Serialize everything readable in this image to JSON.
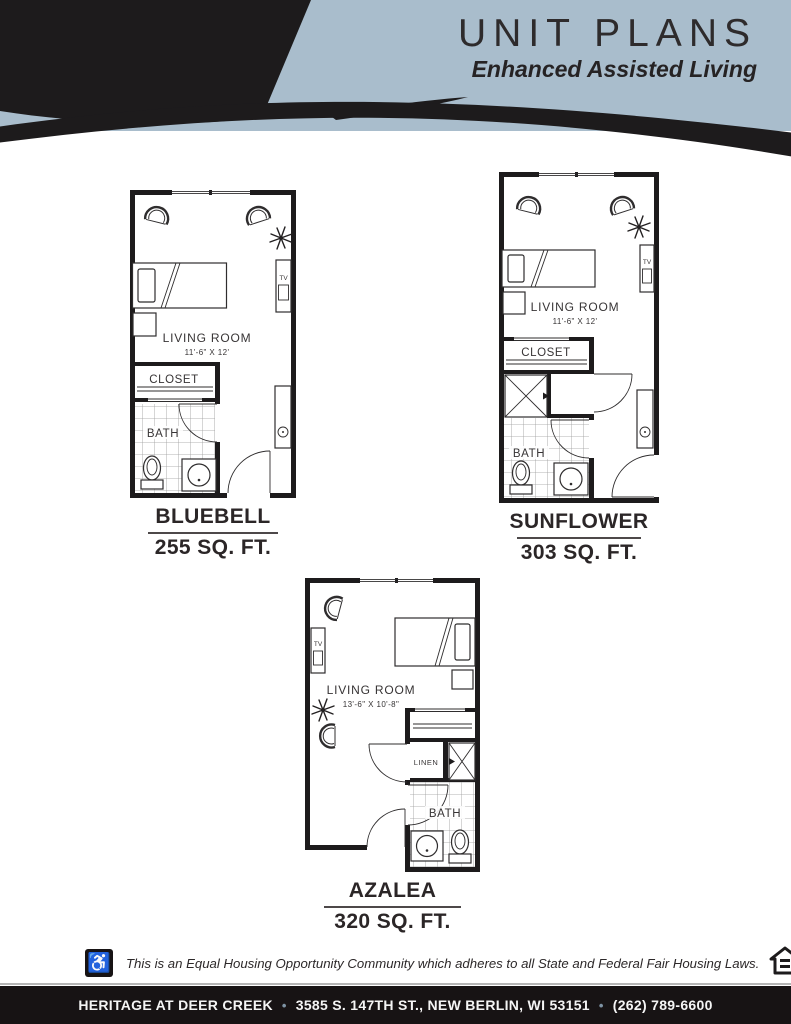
{
  "header": {
    "title": "UNIT PLANS",
    "subtitle": "Enhanced Assisted Living",
    "bg_color": "#a9bdcc",
    "ink_color": "#1d1b1c"
  },
  "plans": [
    {
      "id": "bluebell",
      "name": "BLUEBELL",
      "area": "255 SQ. FT.",
      "living_room_label": "LIVING ROOM",
      "living_room_dim": "11'-6\" X 12'",
      "closet_label": "CLOSET",
      "bath_label": "BATH",
      "tv_label": "TV"
    },
    {
      "id": "sunflower",
      "name": "SUNFLOWER",
      "area": "303 SQ. FT.",
      "living_room_label": "LIVING ROOM",
      "living_room_dim": "11'-6\" X 12'",
      "closet_label": "CLOSET",
      "bath_label": "BATH",
      "tv_label": "TV"
    },
    {
      "id": "azalea",
      "name": "AZALEA",
      "area": "320 SQ. FT.",
      "living_room_label": "LIVING ROOM",
      "living_room_dim": "13'-6\" X 10'-8\"",
      "linen_label": "LINEN",
      "bath_label": "BATH",
      "tv_label": "TV"
    }
  ],
  "footer": {
    "fair_housing_text": "This is an Equal Housing Opportunity Community which adheres to all State and Federal Fair Housing Laws.",
    "company": "HERITAGE AT DEER CREEK",
    "address": "3585 S. 147TH ST., NEW BERLIN, WI 53151",
    "phone": "(262) 789-6600",
    "separator": "•",
    "bar_bg": "#171314",
    "separator_color": "#7e93a4"
  }
}
